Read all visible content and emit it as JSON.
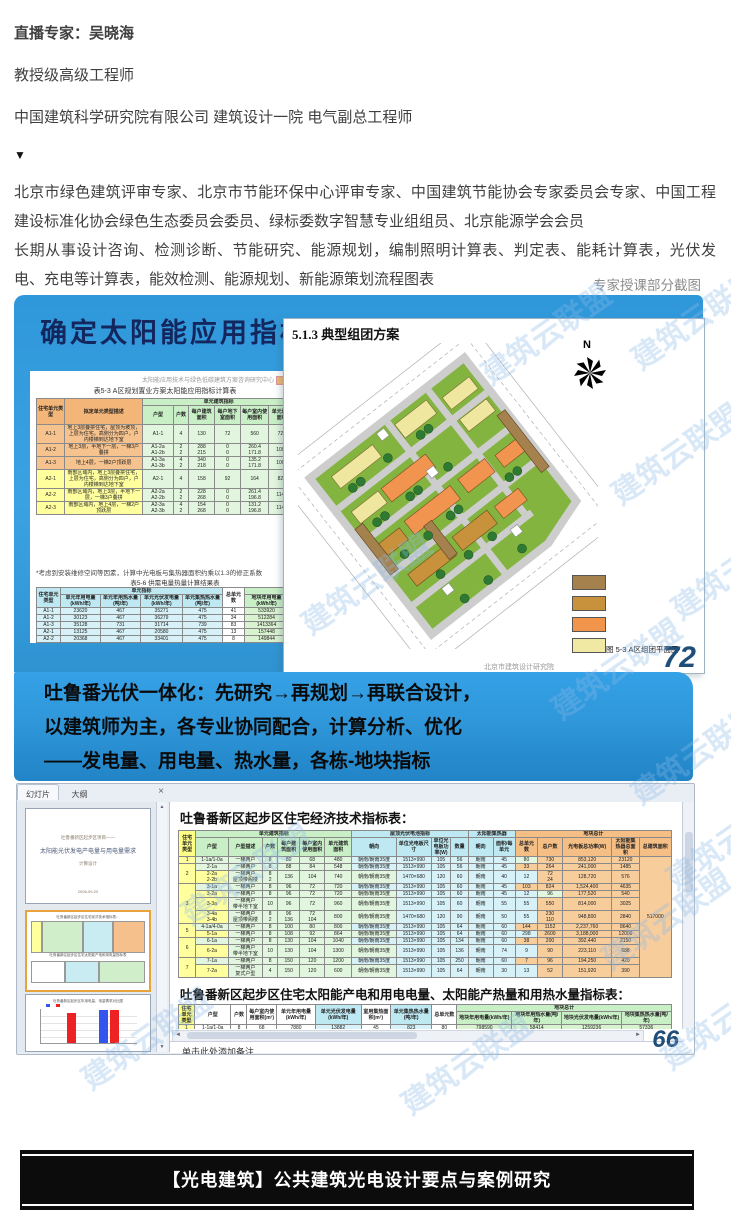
{
  "page": {
    "expert_lines": [
      "直播专家：吴晓海",
      "教授级高级工程师",
      "中国建筑科学研究院有限公司 建筑设计一院 电气副总工程师"
    ],
    "arrow": "▼",
    "bio_paragraphs": [
      "北京市绿色建筑评审专家、北京市节能环保中心评审专家、中国建筑节能协会专家委员会专家、中国工程建设标准化协会绿色生态委员会委员、绿标委数字智慧专业组组员、北京能源学会会员",
      "长期从事设计咨询、检测诊断、节能研究、能源规划，编制照明计算表、判定表、能耗计算表，光伏发电、充电等计算表，能效检测、能源规划、新能源策划流程图表"
    ],
    "screenshots_caption": "专家授课部分截图",
    "footer_banner": "【光电建筑】公共建筑光电设计要点与案例研究",
    "watermark_text": "建筑云联盟",
    "watermarks": [
      {
        "x": 470,
        "y": 310
      },
      {
        "x": 620,
        "y": 295
      },
      {
        "x": 600,
        "y": 430
      },
      {
        "x": 660,
        "y": 545
      },
      {
        "x": 290,
        "y": 560
      },
      {
        "x": 540,
        "y": 645
      },
      {
        "x": 620,
        "y": 730
      },
      {
        "x": 655,
        "y": 815
      },
      {
        "x": 170,
        "y": 850
      },
      {
        "x": 590,
        "y": 895
      },
      {
        "x": 650,
        "y": 995
      },
      {
        "x": 70,
        "y": 1015
      },
      {
        "x": 390,
        "y": 1040
      }
    ]
  },
  "colors": {
    "slide_blue": "#2f98da",
    "navy_page_number": "#1f4e79",
    "thumb_select_border": "#e8a33d",
    "banner_black": "#0c0c0c"
  },
  "slide1": {
    "title": "确定太阳能应用指标",
    "org_tiny_line": "太阳能应用技术与绿色低碳建筑方案咨询研究中心",
    "table1_caption": "表5-3  A区规划置业方案太阳能应用指标计算表",
    "table1": {
      "widths": [
        24,
        66,
        26,
        13,
        22,
        22,
        24,
        22,
        18,
        18,
        13,
        16
      ],
      "col_cls": [
        "",
        "",
        "g",
        "g",
        "g",
        "g",
        "g",
        "g",
        "c",
        "c",
        "c",
        "c"
      ],
      "headers": [
        [
          {
            "t": "住宅单元类型",
            "r": 2,
            "k": "oh"
          },
          {
            "t": "拟定单元类型描述",
            "r": 2,
            "k": "oh"
          },
          {
            "t": "单元建筑指标",
            "c": 6,
            "k": "gh"
          },
          {
            "t": "单元太阳能应用指标",
            "c": 4,
            "k": "ch"
          }
        ],
        [
          {
            "t": "户型",
            "k": "gh"
          },
          {
            "t": "户数",
            "k": "gh"
          },
          {
            "t": "每户建筑面积",
            "k": "gh"
          },
          {
            "t": "每户地下室面积",
            "k": "gh"
          },
          {
            "t": "每户室内使用面积",
            "k": "gh"
          },
          {
            "t": "单元建筑面积",
            "k": "gh"
          },
          {
            "t": "屋顶光电板面积",
            "k": "ch"
          },
          {
            "t": "飘板光电板面积",
            "k": "ch"
          },
          {
            "t": "朝向",
            "k": "ch"
          },
          {
            "t": "集热面积",
            "k": "ch"
          }
        ]
      ],
      "rows": [
        [
          {
            "t": "A1-1",
            "k": "o"
          },
          {
            "t": "地上3层叠拼住宅，屋顶为坡顶，上层为住宅，高侧分为四户，户内楼梯到达地下室",
            "k": "o",
            "d": 1
          },
          "A1-1",
          "4",
          "130",
          "72",
          "560",
          "728",
          "197",
          "0",
          "9",
          "43"
        ],
        [
          {
            "t": "A1-2",
            "k": "o"
          },
          {
            "t": "地上3层，半地下一层，一梯3户叠拼",
            "k": "o",
            "d": 1
          },
          "A1-2a\nA1-2b",
          "2\n2",
          "288\n215",
          "0\n0",
          "260.4\n171.8",
          "1008",
          "192",
          "0",
          "9",
          "43"
        ],
        [
          {
            "t": "A1-3",
            "k": "o"
          },
          {
            "t": "地上4层，一梯2户顶跃层",
            "k": "o",
            "d": 1
          },
          "A1-3a\nA1-3b",
          "4\n2",
          "340\n218",
          "0\n0",
          "135.2\n171.8",
          "1008",
          "171",
          "0",
          "11",
          "94"
        ],
        [
          {
            "t": "A2-1",
            "k": "y"
          },
          {
            "t": "南部区域内，地上3层叠拼住宅，上层为住宅，高侧分为四户，户内楼梯到达地下室",
            "k": "y",
            "d": 1
          },
          "A2-1",
          "4",
          "158",
          "92",
          "164",
          "828",
          "72",
          "135",
          "9",
          "43"
        ],
        [
          {
            "t": "A2-2",
            "k": "y"
          },
          {
            "t": "南部区域内，地上3层，半地下一层，一梯3户叠拼",
            "k": "y",
            "d": 1
          },
          "A2-2a\nA2-2b",
          "2\n2",
          "228\n268",
          "0\n0",
          "261.4\n196.8",
          "1148",
          "72",
          "135",
          "9",
          "43"
        ],
        [
          {
            "t": "A2-3",
            "k": "y"
          },
          {
            "t": "南部区域内，地上4层，一梯2户顶跃层",
            "k": "y",
            "d": 1
          },
          "A2-3a\nA2-3b",
          "4\n2",
          "154\n268",
          "0\n0",
          "131.2\n196.8",
          "1148",
          "91",
          "128",
          "11",
          "94"
        ]
      ]
    },
    "note": "*考虑到安装维修空间等因素，计算中光电板与集热器面积约乘以1.3的修正系数",
    "table2_caption": "表5-6  供需电量热量计算结果表",
    "table2": {
      "widths": [
        24,
        40,
        40,
        42,
        40,
        22,
        44,
        40,
        40
      ],
      "col_cls": [
        "c",
        "c",
        "c",
        "c",
        "c",
        "w",
        "gg",
        "gg",
        "gg"
      ],
      "headers": [
        [
          {
            "t": "住宅单元类型",
            "r": 2,
            "k": "ch"
          },
          {
            "t": "单元指标",
            "c": 4,
            "k": "ch"
          },
          {
            "t": "总单元数",
            "r": 2,
            "k": "wh"
          },
          {
            "t": "地块项目",
            "c": 3,
            "k": "ggh"
          }
        ],
        [
          {
            "t": "单元年用电量(kWh/年)",
            "k": "ch"
          },
          {
            "t": "单元年用热水量(吨/年)",
            "k": "ch"
          },
          {
            "t": "单元光伏发电量(kWh/年)",
            "k": "ch"
          },
          {
            "t": "单元集热热水量(吨/年)",
            "k": "ch"
          },
          {
            "t": "地块年用电量(kWh/年)",
            "k": "ggh"
          },
          {
            "t": "地块年用热水量(吨/年)",
            "k": "ggh"
          },
          {
            "t": "地块光伏发电量(kWh/年)",
            "k": "ggh"
          }
        ]
      ],
      "rows": [
        [
          "A1-1",
          "23620",
          "467",
          "35271",
          "475",
          "41",
          "533920",
          "11476",
          "1433460"
        ],
        [
          "A1-2",
          "30123",
          "467",
          "36279",
          "475",
          "34",
          "512284",
          "17756",
          "1246585"
        ],
        [
          "A1-3",
          "35128",
          "731",
          "31714",
          "739",
          "83",
          "1413364",
          "61677",
          "2735764"
        ],
        [
          "A2-1",
          "13125",
          "467",
          "20580",
          "475",
          "13",
          "157448",
          "5896",
          "241357"
        ],
        [
          "A2-2",
          "20368",
          "467",
          "33401",
          "475",
          "8",
          "149844",
          "3738",
          "267308"
        ]
      ]
    }
  },
  "slide2": {
    "title": "5.1.3 典型组团方案",
    "north_label": "N",
    "legend_colors": [
      "#a5814e",
      "#c8913c",
      "#f1944c",
      "#efe9a3"
    ],
    "caption": "图 5-3   A区组团平面图",
    "org_footer": "北京市建筑设计研究院",
    "page_number": "72"
  },
  "banner": {
    "lines": [
      "吐鲁番光伏一体化：先研究→再规划→再联合设计，",
      "以建筑师为主，各专业协同配合，计算分析、优化",
      "——发电量、用电量、热水量，各栋-地块指标"
    ]
  },
  "ppt": {
    "tabs": [
      "幻灯片",
      "大纲"
    ],
    "close_label": "×",
    "thumb1_lines": [
      "吐鲁番新区起步区项目——",
      "太阳能光伏发电产电量与用电量需求",
      "计算设计",
      "2008-09-20"
    ],
    "thumb2_caption1": "吐鲁番新区起步区住宅经济技术指标表：",
    "thumb2_caption2": "吐鲁番新区起步区住宅太阳能产电和用电量指标表",
    "thumb3_caption": "吐鲁番新区起步区年用电量、电量需求对比图",
    "scroll_up": "▲",
    "scroll_down": "▼",
    "scroll_left": "◄",
    "scroll_right": "►",
    "main": {
      "title1": "吐鲁番新区起步区住宅经济技术指标表：",
      "title2": "吐鲁番新区起步区住宅太阳能产电和用电电量、太阳能产热量和用热水量指标表：",
      "notes_placeholder": "单击此处添加备注",
      "page_number": "66"
    },
    "table1": {
      "widths": [
        14,
        26,
        28,
        12,
        18,
        20,
        22,
        36,
        28,
        16,
        14,
        20,
        18,
        18,
        20,
        40,
        22,
        26
      ],
      "col_cls": [
        "y",
        "g",
        "g",
        "g",
        "g",
        "g",
        "g",
        "c",
        "c",
        "c",
        "c",
        "c",
        "c",
        "or",
        "or",
        "or",
        "or",
        "or"
      ],
      "headers": [
        [
          {
            "t": "住宅单元类型",
            "r": 2,
            "k": "yh"
          },
          {
            "t": "单元建筑指标",
            "c": 6,
            "k": "gh"
          },
          {
            "t": "屋顶光伏电池指标",
            "c": 4,
            "k": "ch"
          },
          {
            "t": "太阳能集热器",
            "c": 2,
            "k": "ch"
          },
          {
            "t": "地块总计",
            "c": 5,
            "k": "orh"
          }
        ],
        [
          {
            "t": "户型",
            "k": "gh"
          },
          {
            "t": "户型描述",
            "k": "gh"
          },
          {
            "t": "户数",
            "k": "gh"
          },
          {
            "t": "每户建筑面积",
            "k": "gh"
          },
          {
            "t": "每户室内使用面积",
            "k": "gh"
          },
          {
            "t": "单元建筑面积",
            "k": "gh"
          },
          {
            "t": "朝向",
            "k": "ch"
          },
          {
            "t": "单位光电板尺寸",
            "k": "ch"
          },
          {
            "t": "单位光电板功率(W)",
            "k": "ch"
          },
          {
            "t": "数量",
            "k": "ch"
          },
          {
            "t": "朝向",
            "k": "ch"
          },
          {
            "t": "面积/每单元",
            "k": "ch"
          },
          {
            "t": "总单元数",
            "k": "orh"
          },
          {
            "t": "总户数",
            "k": "orh"
          },
          {
            "t": "光电板总功率(W)",
            "k": "orh"
          },
          {
            "t": "太阳能集热器总面积",
            "k": "orh"
          },
          {
            "t": "总建筑面积",
            "k": "orh"
          }
        ]
      ],
      "rows": [
        [
          {
            "t": "1",
            "k": "y"
          },
          "1-1a/1-0a",
          "一梯两户",
          "8",
          "80",
          "68",
          "480",
          "朝南/朝南35度",
          "1513×990",
          "105",
          "56",
          "朝南",
          "45",
          "80",
          "730",
          "853,120",
          "23120",
          {
            "t": "517000",
            "r": 13,
            "k": "or"
          }
        ],
        [
          {
            "t": "2",
            "r": 2,
            "k": "y"
          },
          "2-1a",
          "一梯两户",
          "8",
          "88",
          "84",
          "548",
          "朝南/朝南35度",
          "1513×990",
          "105",
          "56",
          "朝南",
          "45",
          "33",
          "264",
          "241,000",
          "1485"
        ],
        [
          "2-2a\n2-2b",
          "一梯两户\n屋顶带阁楼",
          "8\n2",
          "136",
          "104",
          "740",
          "朝南/朝南35度",
          "1470×680",
          "120",
          "60",
          "朝南",
          "40",
          "12",
          "72\n24",
          "128,720",
          "576"
        ],
        [
          {
            "t": "3",
            "r": 4,
            "k": "y"
          },
          "3-1a",
          "一梯两户",
          "8",
          "96",
          "72",
          "720",
          "朝南/朝南35度",
          "1513×990",
          "105",
          "60",
          "朝南",
          "45",
          "103",
          "824",
          "1,524,400",
          "4635"
        ],
        [
          "3-2a",
          "一梯两户",
          "8",
          "96",
          "72",
          "720",
          "朝南/朝南35度",
          "1513×990",
          "105",
          "60",
          "朝南",
          "45",
          "12",
          "96",
          "177,520",
          "540"
        ],
        [
          "3-3a",
          "一梯两户\n带半地下室",
          "10",
          "96",
          "72",
          "960",
          "朝南/朝南35度",
          "1513×990",
          "105",
          "60",
          "朝南",
          "55",
          "55",
          "550",
          "814,000",
          "3025"
        ],
        [
          "3-4a\n3-4b",
          "一梯两户\n屋顶带阁楼",
          "8\n2",
          "96\n136",
          "72\n104",
          "800",
          "朝南/朝南35度",
          "1470×680",
          "120",
          "90",
          "朝南",
          "50",
          "55",
          "230\n110",
          "948,800",
          "2840"
        ],
        [
          {
            "t": "5",
            "r": 2,
            "k": "y"
          },
          "4-1a/4-0a",
          "一梯两户",
          "8",
          "100",
          "80",
          "800",
          "朝南/朝南35度",
          "1513×990",
          "105",
          "64",
          "朝南",
          "60",
          "144",
          "1152",
          "2,237,760",
          "8640"
        ],
        [
          "5-1a",
          "一梯两户",
          "8",
          "108",
          "92",
          "864",
          "朝南/朝南35度",
          "1513×990",
          "105",
          "64",
          "朝南",
          "60",
          "298",
          "2600",
          "3,188,000",
          "12000"
        ],
        [
          {
            "t": "6",
            "r": 2,
            "k": "y"
          },
          "6-1a",
          "一梯两户",
          "8",
          "130",
          "104",
          "1040",
          "朝南/朝南35度",
          "1513×990",
          "105",
          "134",
          "朝南",
          "60",
          "38",
          "200",
          "392,440",
          "2150"
        ],
        [
          "6-2a",
          "一梯两户\n带半地下室",
          "10",
          "130",
          "104",
          "1300",
          "朝南/朝南35度",
          "1513×990",
          "105",
          "136",
          "朝南",
          "74",
          "9",
          "90",
          "223,110",
          "688"
        ],
        [
          {
            "t": "7",
            "r": 2,
            "k": "y"
          },
          "7-1a",
          "一梯两户",
          "8",
          "150",
          "120",
          "1200",
          "朝南/朝南35度",
          "1513×990",
          "105",
          "250",
          "朝南",
          "60",
          "7",
          "96",
          "194,250",
          "420"
        ],
        [
          "7-2a",
          "一梯两户\n复式户型",
          "4",
          "150",
          "120",
          "600",
          "朝南/朝南35度",
          "1513×990",
          "105",
          "64",
          "朝南",
          "30",
          "13",
          "52",
          "151,920",
          "390"
        ]
      ]
    },
    "table2": {
      "widths": [
        14,
        32,
        14,
        26,
        34,
        40,
        26,
        36,
        22,
        48,
        44,
        52,
        44
      ],
      "col_cls": [
        "y",
        "w",
        "w",
        "w",
        "w",
        "c",
        "w",
        "c",
        "w",
        "gg",
        "gg",
        "gg",
        "gg"
      ],
      "headers": [
        [
          {
            "t": "住宅单元类型",
            "r": 2,
            "k": "yh"
          },
          {
            "t": "户型",
            "r": 2,
            "k": "wh"
          },
          {
            "t": "户数",
            "r": 2,
            "k": "wh"
          },
          {
            "t": "每户室内使用面积(m²)",
            "r": 2,
            "k": "wh"
          },
          {
            "t": "单元年用电量(kWh/年)",
            "r": 2,
            "k": "wh"
          },
          {
            "t": "单元光伏发电量(kWh/年)",
            "r": 2,
            "k": "ch"
          },
          {
            "t": "室用集热面积(m²)",
            "r": 2,
            "k": "wh"
          },
          {
            "t": "单元集热热水量(吨/年)",
            "r": 2,
            "k": "ch"
          },
          {
            "t": "总单元数",
            "r": 2,
            "k": "wh"
          },
          {
            "t": "地块总计",
            "c": 4,
            "k": "ggh"
          }
        ],
        [
          {
            "t": "地块年用电量(kWh/年)",
            "k": "ggh"
          },
          {
            "t": "地块年用热水量(吨/年)",
            "k": "ggh"
          },
          {
            "t": "地块光伏发电量(kWh/年)",
            "k": "ggh"
          },
          {
            "t": "地块集热热水量(吨/年)",
            "k": "ggh"
          }
        ]
      ],
      "rows": [
        [
          "1",
          "1-1a/1-0a",
          "8",
          "68",
          "7880",
          "13882",
          "45",
          "823",
          "80",
          "798590",
          "58414",
          "1259236",
          "57336"
        ],
        [
          "2",
          "2-1a",
          "8",
          "84",
          "10240",
          "12687",
          "45",
          "823",
          "33",
          "337920",
          "20236",
          "451882",
          "20567"
        ],
        [
          "",
          "2-2a/2-2b",
          "8",
          "84/104",
          "11840",
          "16578",
          "48",
          "988",
          "12",
          "142080",
          "7972",
          "138937",
          "7978"
        ],
        [
          "3",
          "3-1a",
          "8",
          "72",
          "14080",
          "18875",
          "46",
          "872",
          "103",
          "1148800",
          "63145",
          "2023998",
          "64108"
        ]
      ]
    },
    "thumb3_chart": {
      "type": "bar",
      "series": [
        {
          "name": "年用电量",
          "color": "#3355ee",
          "values": [
            0,
            44
          ]
        },
        {
          "name": "光伏发电量",
          "color": "#ee2222",
          "values": [
            30,
            40
          ]
        }
      ],
      "note": "mini thumbnail bar chart, values approximate pixel heights"
    }
  }
}
